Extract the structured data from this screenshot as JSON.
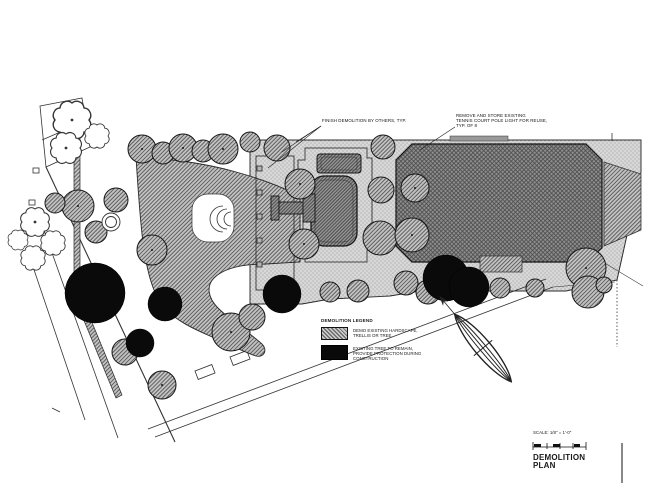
{
  "drawing": {
    "annotations": {
      "finish_demolition": "FINISH DEMOLITION BY OTHERS, TYP.",
      "pole_light": "REMOVE AND STORE EXISTING\nTENNIS COURT POLE LIGHT FOR REUSE,\nTYP. OF 8"
    },
    "legend": {
      "title": "DEMOLITION LEGEND",
      "items": [
        {
          "symbol": "diagonal-hatch",
          "label": "DEMO EXISTING HARDSCAPE,\nTRELLIS OR TREE"
        },
        {
          "symbol": "solid-black",
          "label": "EXISTING TREE TO REMAIN,\nPROVIDE PROTECTION DURING\nCONSTRUCTION"
        }
      ]
    },
    "title_block": {
      "scale": "SCALE: 1/8\" = 1'-0\"",
      "sheet_title": "DEMOLITION\nPLAN"
    },
    "colors": {
      "paper": "#ffffff",
      "ink": "#1a1a1a",
      "court_fill": "#8f8f8f",
      "deck_stipple": "#d8d8d8",
      "demo_hatch": "#c2c2c2",
      "tree_remain": "#0a0a0a"
    }
  }
}
